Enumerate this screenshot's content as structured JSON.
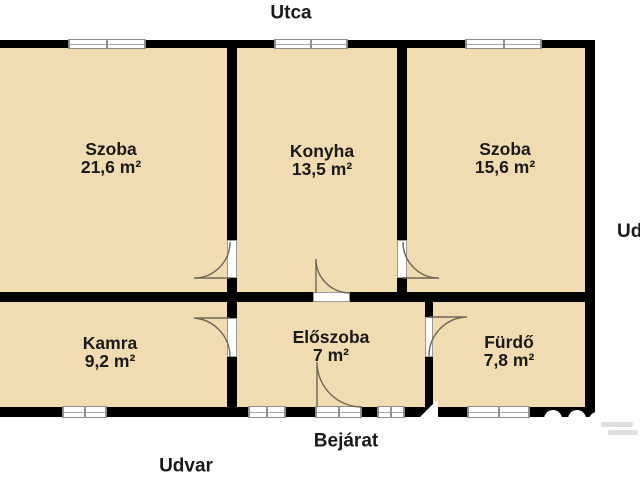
{
  "colors": {
    "background": "#ffffff",
    "floor": "#f0dcb0",
    "wall": "#000000",
    "window_frame": "#8f8f8f",
    "door_arc": "#6e6757",
    "label_text": "#1a1a1a",
    "watermark_white": "#ffffff",
    "watermark_gray": "#d9d9d9"
  },
  "labels": {
    "street": {
      "text": "Utca",
      "cx": 291,
      "cy": 13
    },
    "entrance": {
      "text": "Bejárat",
      "cx": 346,
      "cy": 441
    },
    "yard_bottom": {
      "text": "Udvar",
      "cx": 186,
      "cy": 466
    },
    "yard_right": {
      "text": "Udvar",
      "x": 617,
      "y": 222
    }
  },
  "rooms": [
    {
      "id": "szoba-1",
      "name": "Szoba",
      "area": "21,6 m²",
      "cx": 111,
      "cy": 158
    },
    {
      "id": "konyha",
      "name": "Konyha",
      "area": "13,5 m²",
      "cx": 322,
      "cy": 160
    },
    {
      "id": "szoba-2",
      "name": "Szoba",
      "area": "15,6 m²",
      "cx": 505,
      "cy": 158
    },
    {
      "id": "kamra",
      "name": "Kamra",
      "area": "9,2 m²",
      "cx": 110,
      "cy": 352
    },
    {
      "id": "eloszoba",
      "name": "Előszoba",
      "area": "7 m²",
      "cx": 331,
      "cy": 346
    },
    {
      "id": "furdo",
      "name": "Fürdő",
      "area": "7,8 m²",
      "cx": 509,
      "cy": 351
    }
  ],
  "plan": {
    "floor_rect": {
      "x": 0,
      "y": 40,
      "w": 595,
      "h": 377
    },
    "walls": [
      {
        "x": 0,
        "y": 40,
        "w": 68,
        "h": 8
      },
      {
        "x": 146,
        "y": 40,
        "w": 128,
        "h": 8
      },
      {
        "x": 348,
        "y": 40,
        "w": 117,
        "h": 8
      },
      {
        "x": 542,
        "y": 40,
        "w": 53,
        "h": 8
      },
      {
        "x": 585,
        "y": 40,
        "w": 10,
        "h": 377
      },
      {
        "x": 0,
        "y": 292,
        "w": 313,
        "h": 10
      },
      {
        "x": 350,
        "y": 292,
        "w": 245,
        "h": 10
      },
      {
        "x": 0,
        "y": 407,
        "w": 62,
        "h": 10
      },
      {
        "x": 107,
        "y": 407,
        "w": 141,
        "h": 10
      },
      {
        "x": 286,
        "y": 407,
        "w": 29,
        "h": 10
      },
      {
        "x": 362,
        "y": 407,
        "w": 15,
        "h": 10
      },
      {
        "x": 405,
        "y": 407,
        "w": 62,
        "h": 10
      },
      {
        "x": 530,
        "y": 407,
        "w": 65,
        "h": 10
      },
      {
        "x": 227,
        "y": 48,
        "w": 10,
        "h": 192
      },
      {
        "x": 227,
        "y": 278,
        "w": 10,
        "h": 14
      },
      {
        "x": 397,
        "y": 48,
        "w": 10,
        "h": 192
      },
      {
        "x": 397,
        "y": 278,
        "w": 10,
        "h": 14
      },
      {
        "x": 227,
        "y": 302,
        "w": 10,
        "h": 16
      },
      {
        "x": 227,
        "y": 357,
        "w": 10,
        "h": 50
      },
      {
        "x": 425,
        "y": 302,
        "w": 8,
        "h": 15
      },
      {
        "x": 425,
        "y": 357,
        "w": 8,
        "h": 50
      }
    ],
    "windows": [
      {
        "x": 68,
        "y": 39,
        "w": 78,
        "h": 10
      },
      {
        "x": 274,
        "y": 39,
        "w": 74,
        "h": 10
      },
      {
        "x": 465,
        "y": 39,
        "w": 77,
        "h": 10
      },
      {
        "x": 62,
        "y": 406,
        "w": 45,
        "h": 12
      },
      {
        "x": 248,
        "y": 406,
        "w": 38,
        "h": 12
      },
      {
        "x": 377,
        "y": 406,
        "w": 28,
        "h": 12
      },
      {
        "x": 467,
        "y": 406,
        "w": 63,
        "h": 12
      },
      {
        "x": 315,
        "y": 406,
        "w": 47,
        "h": 12
      }
    ],
    "door_panels": [
      {
        "x": 227,
        "y": 240,
        "w": 10,
        "h": 38
      },
      {
        "x": 397,
        "y": 240,
        "w": 10,
        "h": 38
      },
      {
        "x": 227,
        "y": 318,
        "w": 10,
        "h": 39
      },
      {
        "x": 425,
        "y": 317,
        "w": 8,
        "h": 40
      },
      {
        "x": 313,
        "y": 292,
        "w": 37,
        "h": 10
      }
    ],
    "door_arcs": [
      {
        "id": "door-szoba1-konyha",
        "path": "M 230 278 L 194 278 A 36 36 0 0 0 230 242"
      },
      {
        "id": "door-konyha-szoba2",
        "path": "M 403 278 L 439 278 A 36 36 0 0 1 403 242"
      },
      {
        "id": "door-kamra-eloszoba",
        "path": "M 230 318 L 194 318 A 39 39 0 0 1 230 357"
      },
      {
        "id": "door-eloszoba-furdo",
        "path": "M 429 317 L 467 317 A 39 39 0 0 0 429 356"
      },
      {
        "id": "door-konyha-eloszoba",
        "path": "M 316 293 L 316 259 A 34 34 0 0 0 350 293"
      },
      {
        "id": "door-entrance",
        "path": "M 317 407 L 317 362 A 45 45 0 0 0 362 407"
      }
    ],
    "watermark": {
      "white_shapes": [
        {
          "type": "triangle",
          "points": "420,417 438,417 438,399"
        },
        {
          "type": "circle",
          "cx": 553,
          "cy": 419,
          "r": 9
        },
        {
          "type": "circle",
          "cx": 577,
          "cy": 419,
          "r": 9
        },
        {
          "type": "circle",
          "cx": 597,
          "cy": 420,
          "r": 8
        }
      ],
      "gray_smudges": [
        {
          "x": 601,
          "y": 422,
          "w": 32,
          "h": 5
        },
        {
          "x": 608,
          "y": 430,
          "w": 30,
          "h": 5
        }
      ]
    }
  }
}
